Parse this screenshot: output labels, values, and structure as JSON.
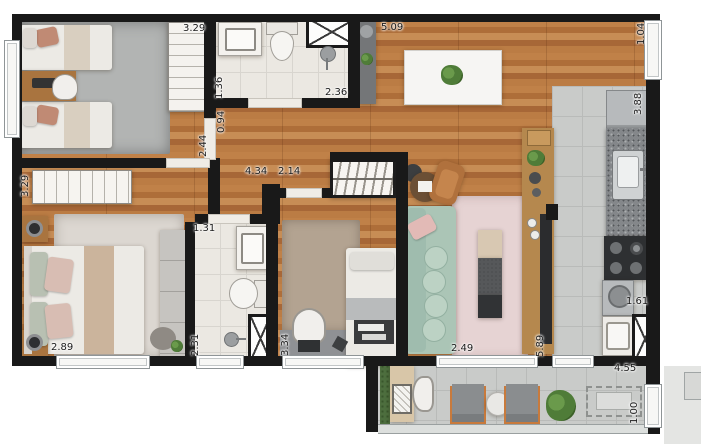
{
  "document": {
    "kind": "apartment-floor-plan",
    "units": "meters",
    "measurements": [
      {
        "id": "bed1-closet",
        "value": "3.29",
        "orient": "h",
        "x": 183,
        "y": 24
      },
      {
        "id": "bath1-width",
        "value": "1.36",
        "orient": "v",
        "x": 215,
        "y": 99
      },
      {
        "id": "hall-width",
        "value": "0.94",
        "orient": "v",
        "x": 217,
        "y": 133
      },
      {
        "id": "bed1-door",
        "value": "2.44",
        "orient": "v",
        "x": 199,
        "y": 157
      },
      {
        "id": "bath1-length",
        "value": "2.36",
        "orient": "h",
        "x": 325,
        "y": 88
      },
      {
        "id": "living-top",
        "value": "5.09",
        "orient": "h",
        "x": 381,
        "y": 23
      },
      {
        "id": "window-right",
        "value": "1.04",
        "orient": "v",
        "x": 637,
        "y": 45
      },
      {
        "id": "kitchen-length",
        "value": "3.88",
        "orient": "v",
        "x": 634,
        "y": 115
      },
      {
        "id": "hall-length",
        "value": "4.34",
        "orient": "h",
        "x": 245,
        "y": 167
      },
      {
        "id": "hall-branch",
        "value": "2.14",
        "orient": "h",
        "x": 278,
        "y": 167
      },
      {
        "id": "bed2-side",
        "value": "3.29",
        "orient": "v",
        "x": 21,
        "y": 197
      },
      {
        "id": "bath2-width",
        "value": "1.31",
        "orient": "h",
        "x": 193,
        "y": 224
      },
      {
        "id": "bed2-width",
        "value": "2.89",
        "orient": "h",
        "x": 51,
        "y": 343
      },
      {
        "id": "bath2-length",
        "value": "2.31",
        "orient": "v",
        "x": 191,
        "y": 356
      },
      {
        "id": "room3-length",
        "value": "3.34",
        "orient": "v",
        "x": 281,
        "y": 356
      },
      {
        "id": "living-width",
        "value": "2.49",
        "orient": "h",
        "x": 451,
        "y": 344
      },
      {
        "id": "living-length",
        "value": "5.89",
        "orient": "v",
        "x": 536,
        "y": 357
      },
      {
        "id": "laundry-width",
        "value": "1.61",
        "orient": "h",
        "x": 626,
        "y": 297
      },
      {
        "id": "balcony-length",
        "value": "4.55",
        "orient": "h",
        "x": 614,
        "y": 364
      },
      {
        "id": "balcony-width",
        "value": "1.00",
        "orient": "v",
        "x": 630,
        "y": 424
      }
    ],
    "rooms": [
      {
        "name": "bedroom-1",
        "fixtures": [
          "twin-bed",
          "twin-bed",
          "desk",
          "chair",
          "wardrobe",
          "window"
        ]
      },
      {
        "name": "bathroom-1",
        "fixtures": [
          "vanity-sink",
          "toilet",
          "shower",
          "ventilation-shaft"
        ]
      },
      {
        "name": "dining-living",
        "fixtures": [
          "dining-table",
          "six-chairs",
          "plant",
          "sofa",
          "rug",
          "coffee-bench",
          "lounge-chair",
          "side-table",
          "sideboard",
          "entry-console"
        ]
      },
      {
        "name": "kitchen",
        "fixtures": [
          "fridge",
          "counter-sink",
          "cooktop",
          "bar-counter"
        ]
      },
      {
        "name": "bedroom-2",
        "fixtures": [
          "double-bed",
          "nightstand",
          "nightstand",
          "wardrobe",
          "closet",
          "pouf",
          "window"
        ]
      },
      {
        "name": "bathroom-2",
        "fixtures": [
          "vanity-sink",
          "toilet",
          "shower",
          "ventilation-shaft",
          "window"
        ]
      },
      {
        "name": "bedroom-3-office",
        "fixtures": [
          "single-bed",
          "desk",
          "chair",
          "laptop",
          "hanger-wardrobe",
          "rug",
          "window"
        ]
      },
      {
        "name": "laundry",
        "fixtures": [
          "washer",
          "laundry-sink",
          "ventilation-shaft"
        ]
      },
      {
        "name": "balcony",
        "fixtures": [
          "planter",
          "grill-table",
          "chair",
          "armchair",
          "round-table",
          "armchair",
          "plant",
          "future-table-dashed",
          "glass-railing"
        ]
      }
    ],
    "palette": {
      "wall": "#191919",
      "wood": "#b5773f",
      "tile_light": "#ebe8e2",
      "tile_gray": "#c9cbc9",
      "sofa_green": "#abc5b6",
      "rug_pink": "#e6d3d3",
      "leather": "#b0713d",
      "accent_orange": "#c87a3c",
      "plant_green": "#4f7c38",
      "appliance_steel": "#b7babc"
    }
  }
}
